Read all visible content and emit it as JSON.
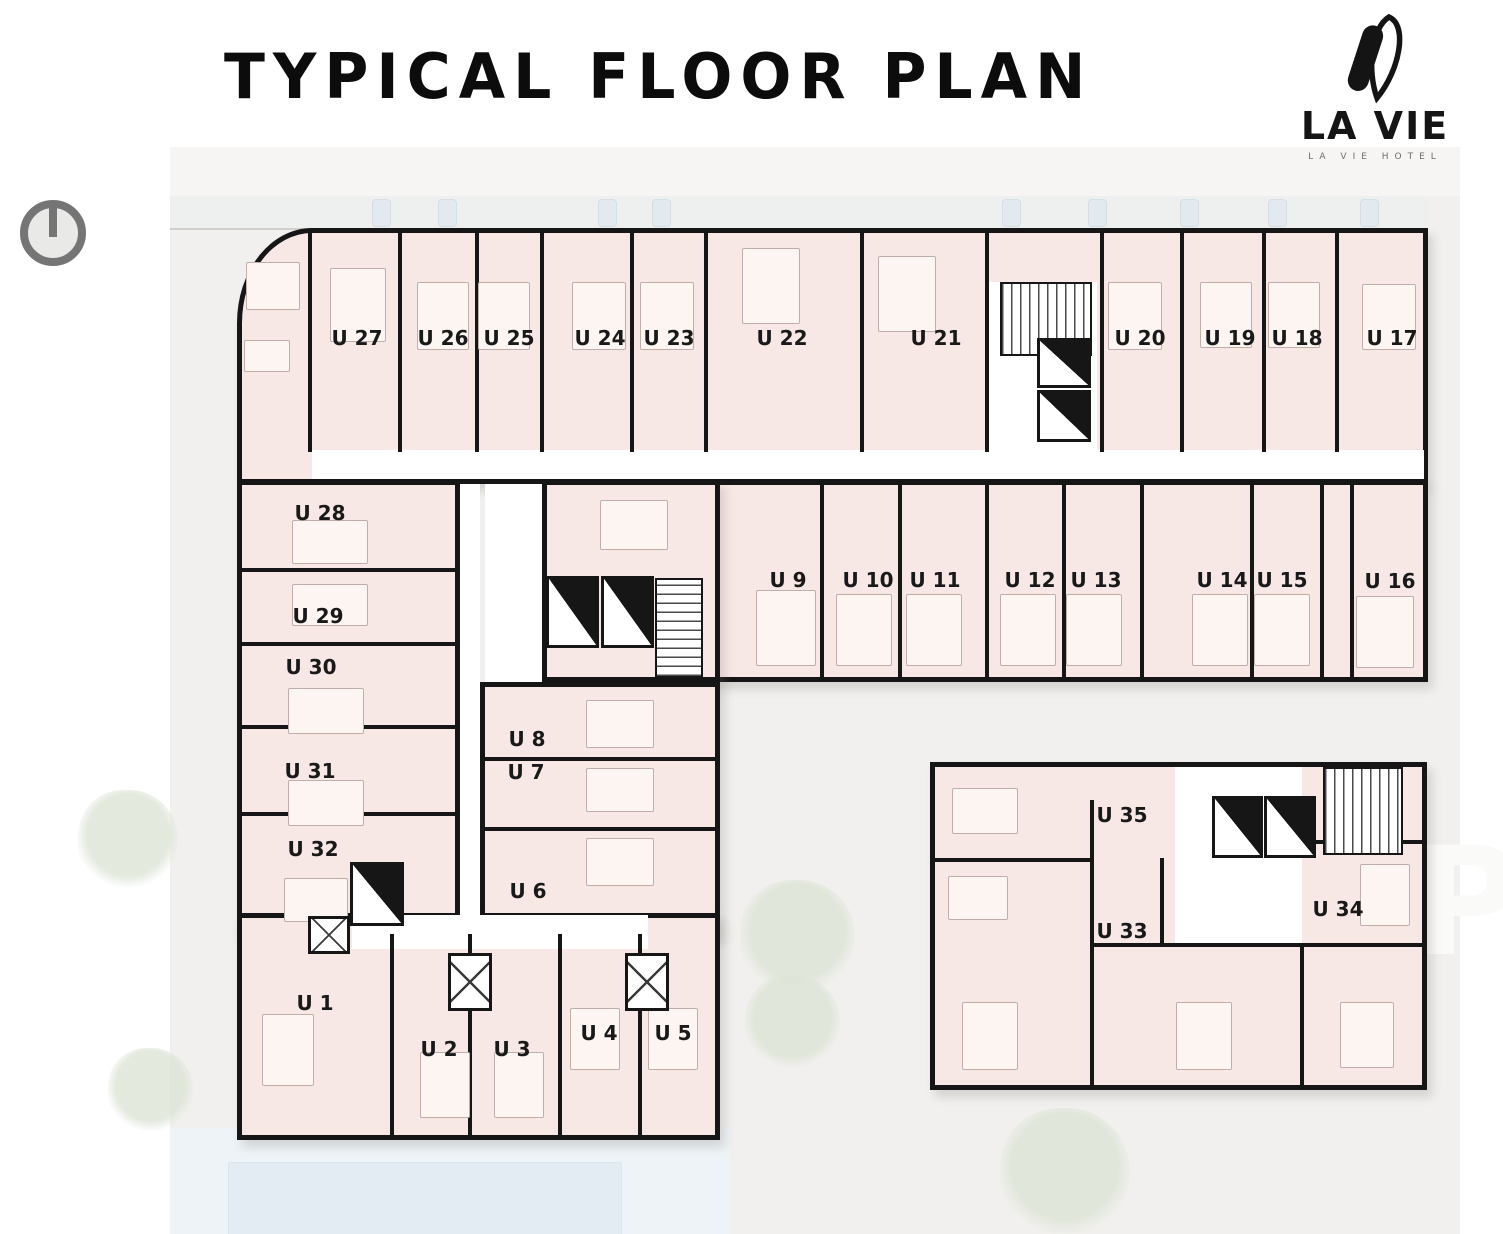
{
  "header": {
    "title": "TYPICAL FLOOR PLAN"
  },
  "logo": {
    "brand": "LA VIE",
    "tagline": "LA VIE HOTEL",
    "mark_icon": "la-vie-v-icon"
  },
  "compass_icon": "north-compass-icon",
  "site": {
    "watermark_letter": "P"
  },
  "colors": {
    "room_fill": "#f7e8e5",
    "wall": "#161616",
    "site_bg": "#f1f0ee",
    "corridor": "#ffffff",
    "pool": "#e2ecf2",
    "tree": "#dde4d6",
    "title_text": "#0c0c0c"
  },
  "units": [
    {
      "id": "U1",
      "label": "U 1"
    },
    {
      "id": "U2",
      "label": "U 2"
    },
    {
      "id": "U3",
      "label": "U 3"
    },
    {
      "id": "U4",
      "label": "U 4"
    },
    {
      "id": "U5",
      "label": "U 5"
    },
    {
      "id": "U6",
      "label": "U 6"
    },
    {
      "id": "U7",
      "label": "U 7"
    },
    {
      "id": "U8",
      "label": "U 8"
    },
    {
      "id": "U9",
      "label": "U 9"
    },
    {
      "id": "U10",
      "label": "U 10"
    },
    {
      "id": "U11",
      "label": "U 11"
    },
    {
      "id": "U12",
      "label": "U 12"
    },
    {
      "id": "U13",
      "label": "U 13"
    },
    {
      "id": "U14",
      "label": "U 14"
    },
    {
      "id": "U15",
      "label": "U 15"
    },
    {
      "id": "U16",
      "label": "U 16"
    },
    {
      "id": "U17",
      "label": "U 17"
    },
    {
      "id": "U18",
      "label": "U 18"
    },
    {
      "id": "U19",
      "label": "U 19"
    },
    {
      "id": "U20",
      "label": "U 20"
    },
    {
      "id": "U21",
      "label": "U 21"
    },
    {
      "id": "U22",
      "label": "U 22"
    },
    {
      "id": "U23",
      "label": "U 23"
    },
    {
      "id": "U24",
      "label": "U 24"
    },
    {
      "id": "U25",
      "label": "U 25"
    },
    {
      "id": "U26",
      "label": "U 26"
    },
    {
      "id": "U27",
      "label": "U 27"
    },
    {
      "id": "U28",
      "label": "U 28"
    },
    {
      "id": "U29",
      "label": "U 29"
    },
    {
      "id": "U30",
      "label": "U 30"
    },
    {
      "id": "U31",
      "label": "U 31"
    },
    {
      "id": "U32",
      "label": "U 32"
    },
    {
      "id": "U33",
      "label": "U 33"
    },
    {
      "id": "U34",
      "label": "U 34"
    },
    {
      "id": "U35",
      "label": "U 35"
    }
  ]
}
